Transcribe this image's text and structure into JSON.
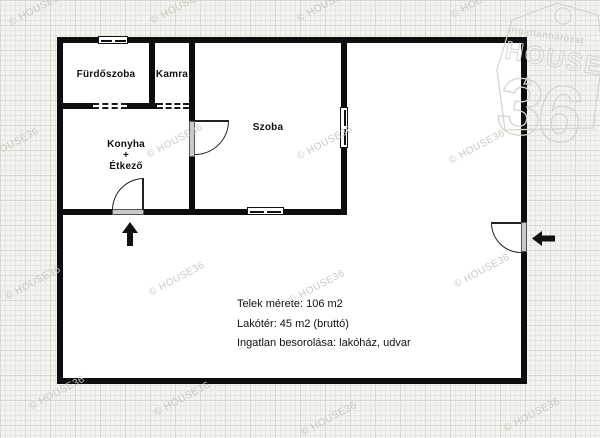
{
  "floorplan": {
    "rooms": {
      "furdoszoba": "Fürdőszoba",
      "kamra": "Kamra",
      "szoba": "Szoba",
      "konyha_line1": "Konyha",
      "konyha_line2": "+",
      "konyha_line3": "Étkező"
    },
    "info": {
      "telek": "Telek mérete: 106 m2",
      "lakoter": "Lakótér: 45 m2 (bruttó)",
      "besorolas": "Ingatlan besorolása: lakóház, udvar"
    }
  },
  "watermark_text": "© HOUSE36",
  "logo": {
    "line1": "Ingatlanhálózat",
    "line2": "HOUSE",
    "line3": "36"
  },
  "colors": {
    "wall": "#0d0d0d",
    "paper": "#f3f3ef",
    "grid_minor": "#e7e7e0",
    "grid_major": "#dadad1",
    "plot_fill": "#ffffff",
    "watermark": "#c9c8c1",
    "logo_outline": "#d6d5cf",
    "door_jamb": "#c9c9c9"
  }
}
